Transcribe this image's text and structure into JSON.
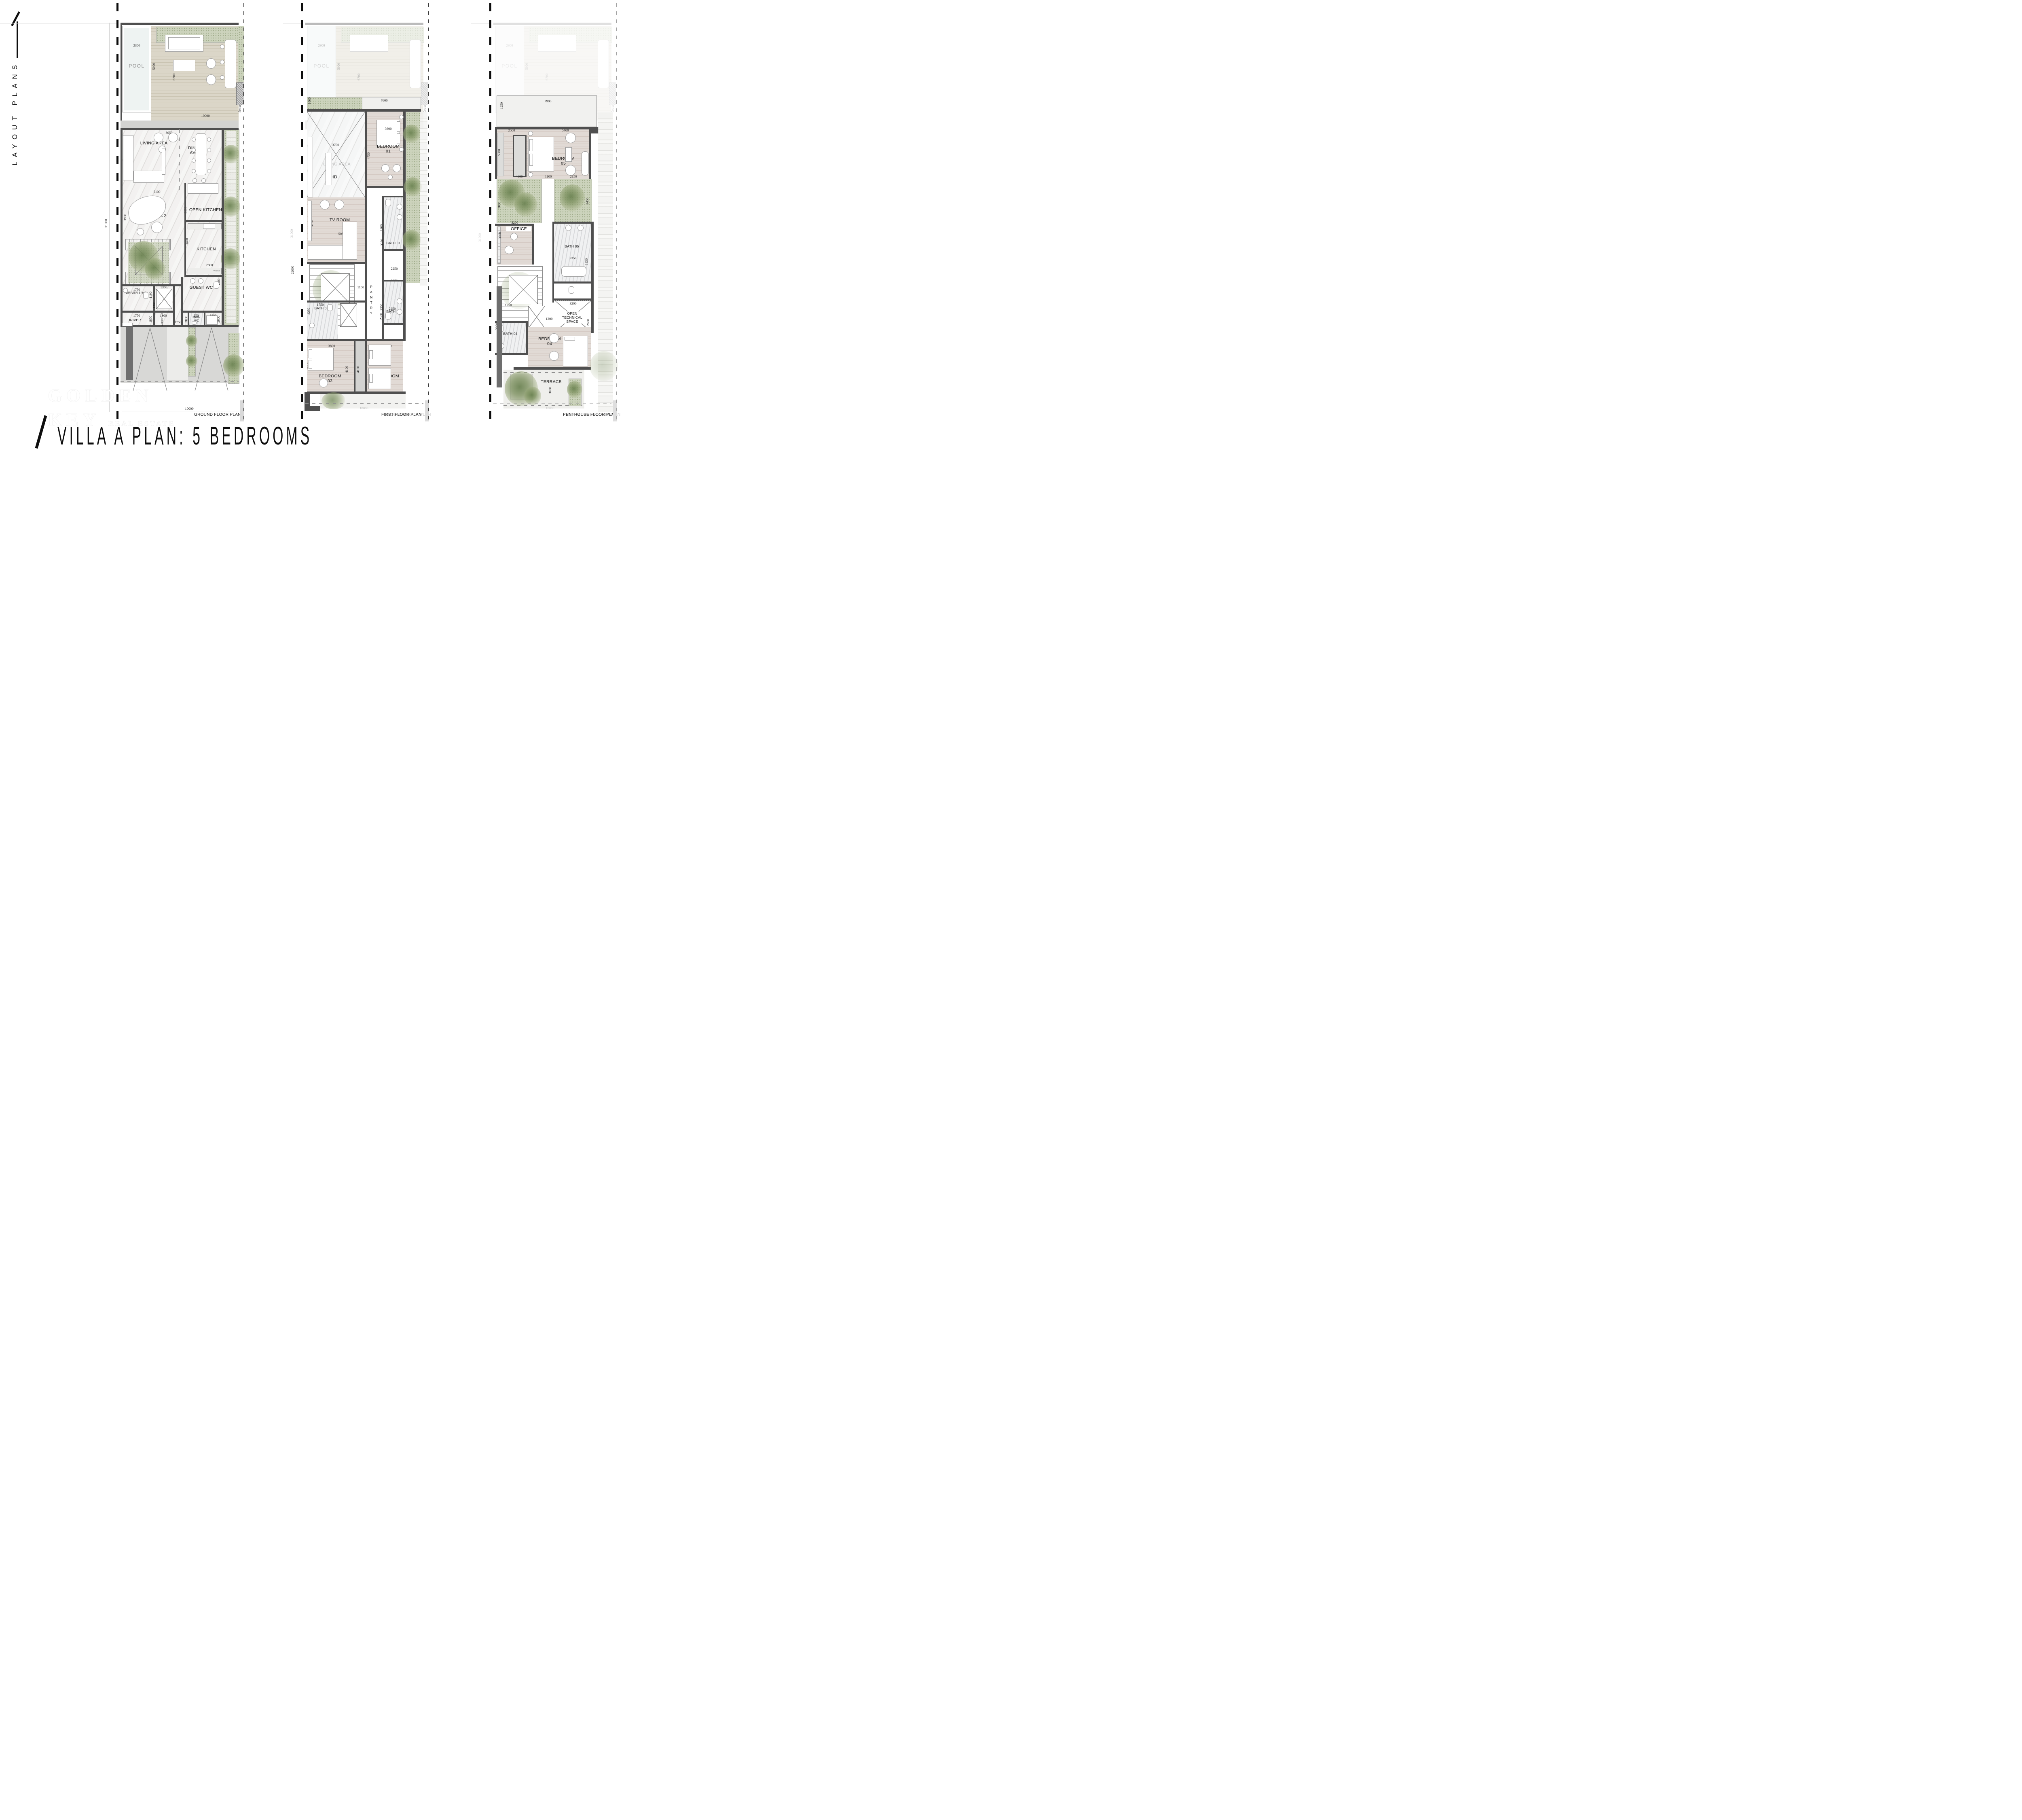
{
  "branding": {
    "side_label": "LAYOUT PLANS",
    "title": "VILLA A PLAN: 5 BEDROOMS"
  },
  "watermark": {
    "line1": "GOLDEN",
    "line2": "KEY",
    "line3": "REAL ESTATE"
  },
  "plans": [
    {
      "footer": "GROUND FLOOR PLAN",
      "rooms": {
        "pool": "POOL",
        "living": "LIVING AREA",
        "dining": "DINING AREA",
        "living2": "LIVING AREA 2",
        "open_kitchen": "OPEN KITCHEN",
        "kitchen": "KITCHEN",
        "guest_wc": "GUEST WC",
        "driver_wc": "DRIVER'S WC",
        "driver": "DRIVER",
        "laundry": "LAUNDRY",
        "maid_wc": "MAID WC",
        "maid": "MAID",
        "bbq": "BBQ",
        "fridge": "FRIDGE"
      },
      "dims": {
        "pool_w": "2300",
        "pool_l": "5000",
        "deck_d": "6700",
        "deck_w": "10000",
        "living_w": "8050",
        "living_d": "6750",
        "living2_w": "5100",
        "living2_d": "3900",
        "openkitchen_d": "2850",
        "kitchen_d": "3400",
        "kitchen_w": "2800",
        "guestwc_d": "1600",
        "driverwc_w": "1750",
        "driverwc_d": "1100",
        "lift_w": "1300",
        "lift_d": "1300",
        "driver_w": "1750",
        "driver_d": "1850",
        "laundry_w": "1300",
        "hall_w": "1750",
        "maidwc_w": "950",
        "maid_w": "1800",
        "maidwc_d": "2000",
        "maid_d": "2000",
        "site_l": "31000",
        "site_w": "10000"
      }
    },
    {
      "footer": "FIRST FLOOR PLAN",
      "footer_ghost": "GROUND FLOOR PLAN",
      "rooms": {
        "living_void_ghost": "LIVING AREA",
        "void": "VOID",
        "bed1": "BEDROOM 01",
        "tv": "TV ROOM",
        "bath1": "BATH 01",
        "pantry": "PANTRY",
        "bath2": "BATH 02",
        "bath3": "BATH 03",
        "bed3": "BEDROOM 03",
        "bed2": "BEDROOM 02"
      },
      "dims": {
        "planter_d": "1000",
        "terrace_w": "7600",
        "void_w": "3700",
        "void_d": "6750",
        "bed1_w": "3600",
        "side_w": "600",
        "bed1_d": "4750",
        "niche_w": "225",
        "hall_d": "3100",
        "tv_d": "3750",
        "tv_w": "5050",
        "bath1_d": "3350",
        "bath1_w": "2250",
        "bath2_w": "2250",
        "corr_w": "1100",
        "bath2_d": "3350",
        "bath3_w": "1750",
        "bath3_d": "3250",
        "hall2_w": "2250",
        "hall2_d": "2300",
        "bed3_w": "3800",
        "bed3_d": "3200",
        "bed3_l": "4100",
        "bed2_w": "3500",
        "bed2_l": "4100",
        "level_l": "22000"
      }
    },
    {
      "footer": "PENTHOUSE FLOOR PLAN",
      "rooms": {
        "bed5": "BEDROOM 05",
        "office": "OFFICE",
        "bath5": "BATH 05",
        "tech": "OPEN TECHNICAL SPACE",
        "bath4": "BATH 04",
        "bed4": "BEDROOM 04",
        "terrace": "TERRACE"
      },
      "dims": {
        "terrace_w": "7900",
        "terrace_d": "1250",
        "bed5_a": "2500",
        "bed5_w": "5400",
        "bed5_d": "5000",
        "planter_w": "4600",
        "planter_d": "2000",
        "gap_w": "1100",
        "planter2_w": "2150",
        "planter2_d": "3450",
        "office_w": "3200",
        "office_d": "3000",
        "bath5_w": "3350",
        "bath5_d": "3850",
        "tech_w": "3200",
        "tech_d": "2650",
        "bath4_w": "1750",
        "corr_w": "1200",
        "bath4_d": "3000",
        "bed4_d": "3250",
        "terrace2_d": "3000"
      }
    }
  ]
}
